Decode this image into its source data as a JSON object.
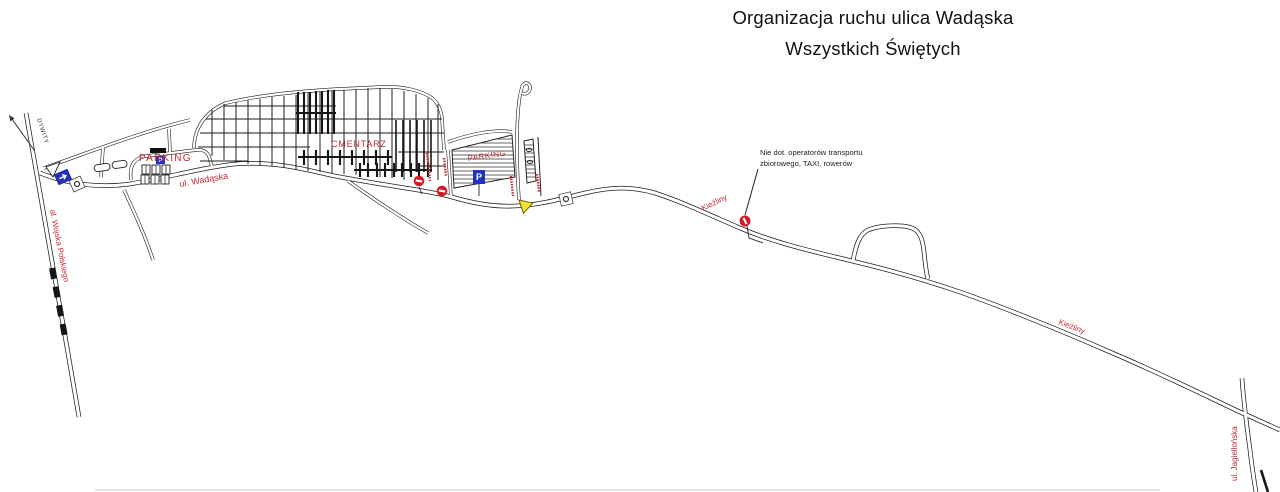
{
  "title": {
    "line1": "Organizacja ruchu ulica Wadąska",
    "line2": "Wszystkich Świętych"
  },
  "annotations": {
    "direction_sign": "DYWITY",
    "note_line1": "Nie dot. operatorów transportu",
    "note_line2": "zbiorowego, TAXI, rowerów"
  },
  "streets": {
    "wadaska": "ul. Wadąska",
    "wojska_polskiego": "al. Wojska Polskiego",
    "kiezliny_north": "Kieźliny",
    "kiezliny_south": "Kieźliny",
    "jagiellonska": "ul. Jagiellońska"
  },
  "areas": {
    "parking_west": "PARKING",
    "cmentarz": "CMENTARZ",
    "parking_east": "PARKING"
  },
  "signs": {
    "parking_letter": "P"
  },
  "colors": {
    "label_red": "#C42B33",
    "sign_red": "#D01A24",
    "sign_blue": "#2231C4",
    "sign_yellow": "#F2E434"
  }
}
